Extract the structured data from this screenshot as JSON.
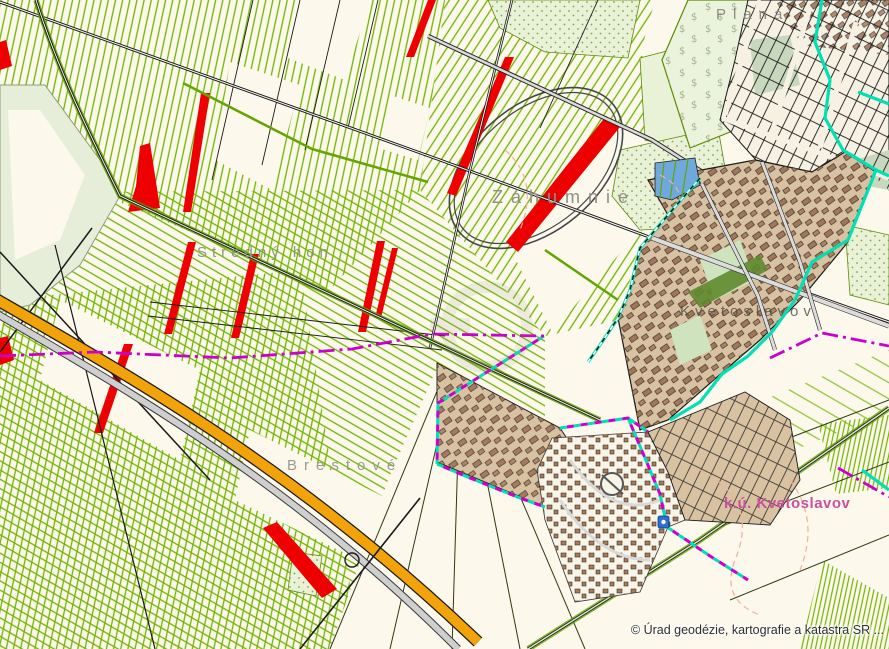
{
  "map": {
    "labels": {
      "plana": "Planá",
      "zahumnie": "Záhumnie",
      "stredny_hon": "Stredný hon",
      "brestove": "Brestové",
      "village": "Kvetoslavov",
      "cadastral_unit": "k.ú. Kvetoslavov"
    },
    "attribution": "© Úrad geodézie, kartografie a katastra SR ...",
    "colors": {
      "background": "#FCF8EC",
      "field_stripe_green": "#6FB400",
      "highlighted_parcel_red": "#EE0000",
      "road_orange": "#F2A30A",
      "boundary_cyan": "#00E0B4",
      "boundary_magenta": "#CC00CC",
      "built_up_tan": "#D9C2A2",
      "building_brown": "#9B6F52",
      "water_blue": "#6FA8DC",
      "label_gray": "#8C8C82",
      "cadastral_label_pink": "#C8509E"
    }
  }
}
